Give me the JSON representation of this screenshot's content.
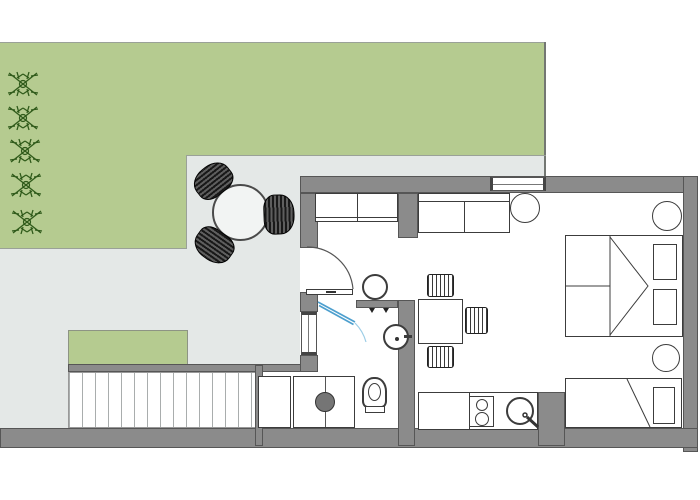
{
  "scene": {
    "type": "architectural floor plan",
    "title": "Studio apartment floor plan with garden, patio, bathroom, kitchen and sleeping area",
    "text_content": "none (drawing only, no visible text)"
  },
  "colors": {
    "lawn": "#b5cb90",
    "patio": "#e4e8e7",
    "wall": "#8b8b8b",
    "walledge": "#565656",
    "outline": "#3c3c3c",
    "glass": "#4d9fce",
    "drum": "#757575",
    "deckline": "#a9adad",
    "plant": "#2f5a1a",
    "boundary": "#9aa198"
  },
  "labels": {
    "plan": "Apartment floor plan",
    "lawn": "Lawn",
    "patio": "Patio",
    "planter": "Planter bed",
    "deck": "Wooden deck",
    "shrub": "Shrub",
    "garden_table": "Round garden table",
    "garden_chair": "Wicker garden chair",
    "entrance_door": "Entrance door",
    "wardrobe": "Wardrobe",
    "stool": "Round stool",
    "sofa": "Sofa",
    "side_table": "Round side table",
    "dining_table": "Dining table",
    "dining_chair": "Dining chair",
    "shower": "Shower glass door",
    "washbasin": "Washbasin",
    "toilet": "Toilet",
    "washing_machine": "Washing machine",
    "bath_cabinet": "Bathroom cabinet",
    "kitchen_counter": "Kitchen counter",
    "cooktop": "Two-burner cooktop",
    "sink": "Kitchen sink",
    "double_bed": "Double bed",
    "single_bed": "Single bed",
    "window": "Window",
    "wall": "Wall"
  },
  "inventory": {
    "outdoor": {
      "shrubs": 5,
      "garden_chairs": 3,
      "garden_tables": 1,
      "deck_planks": 14
    },
    "interior": {
      "entry": [
        "entrance door",
        "wardrobe",
        "round stool"
      ],
      "living": [
        "sofa",
        "round side table",
        "dining table",
        "3 dining chairs"
      ],
      "bathroom": [
        "glass shower",
        "washbasin",
        "toilet",
        "washing machine",
        "cabinet"
      ],
      "kitchen": [
        "counter",
        "two-burner cooktop",
        "round sink"
      ],
      "sleeping": [
        "double bed with 2 pillows",
        "single bed with 1 pillow",
        "2 round bedside tables"
      ]
    },
    "windows": {
      "top_wall": 1,
      "left_wall": 1
    }
  }
}
